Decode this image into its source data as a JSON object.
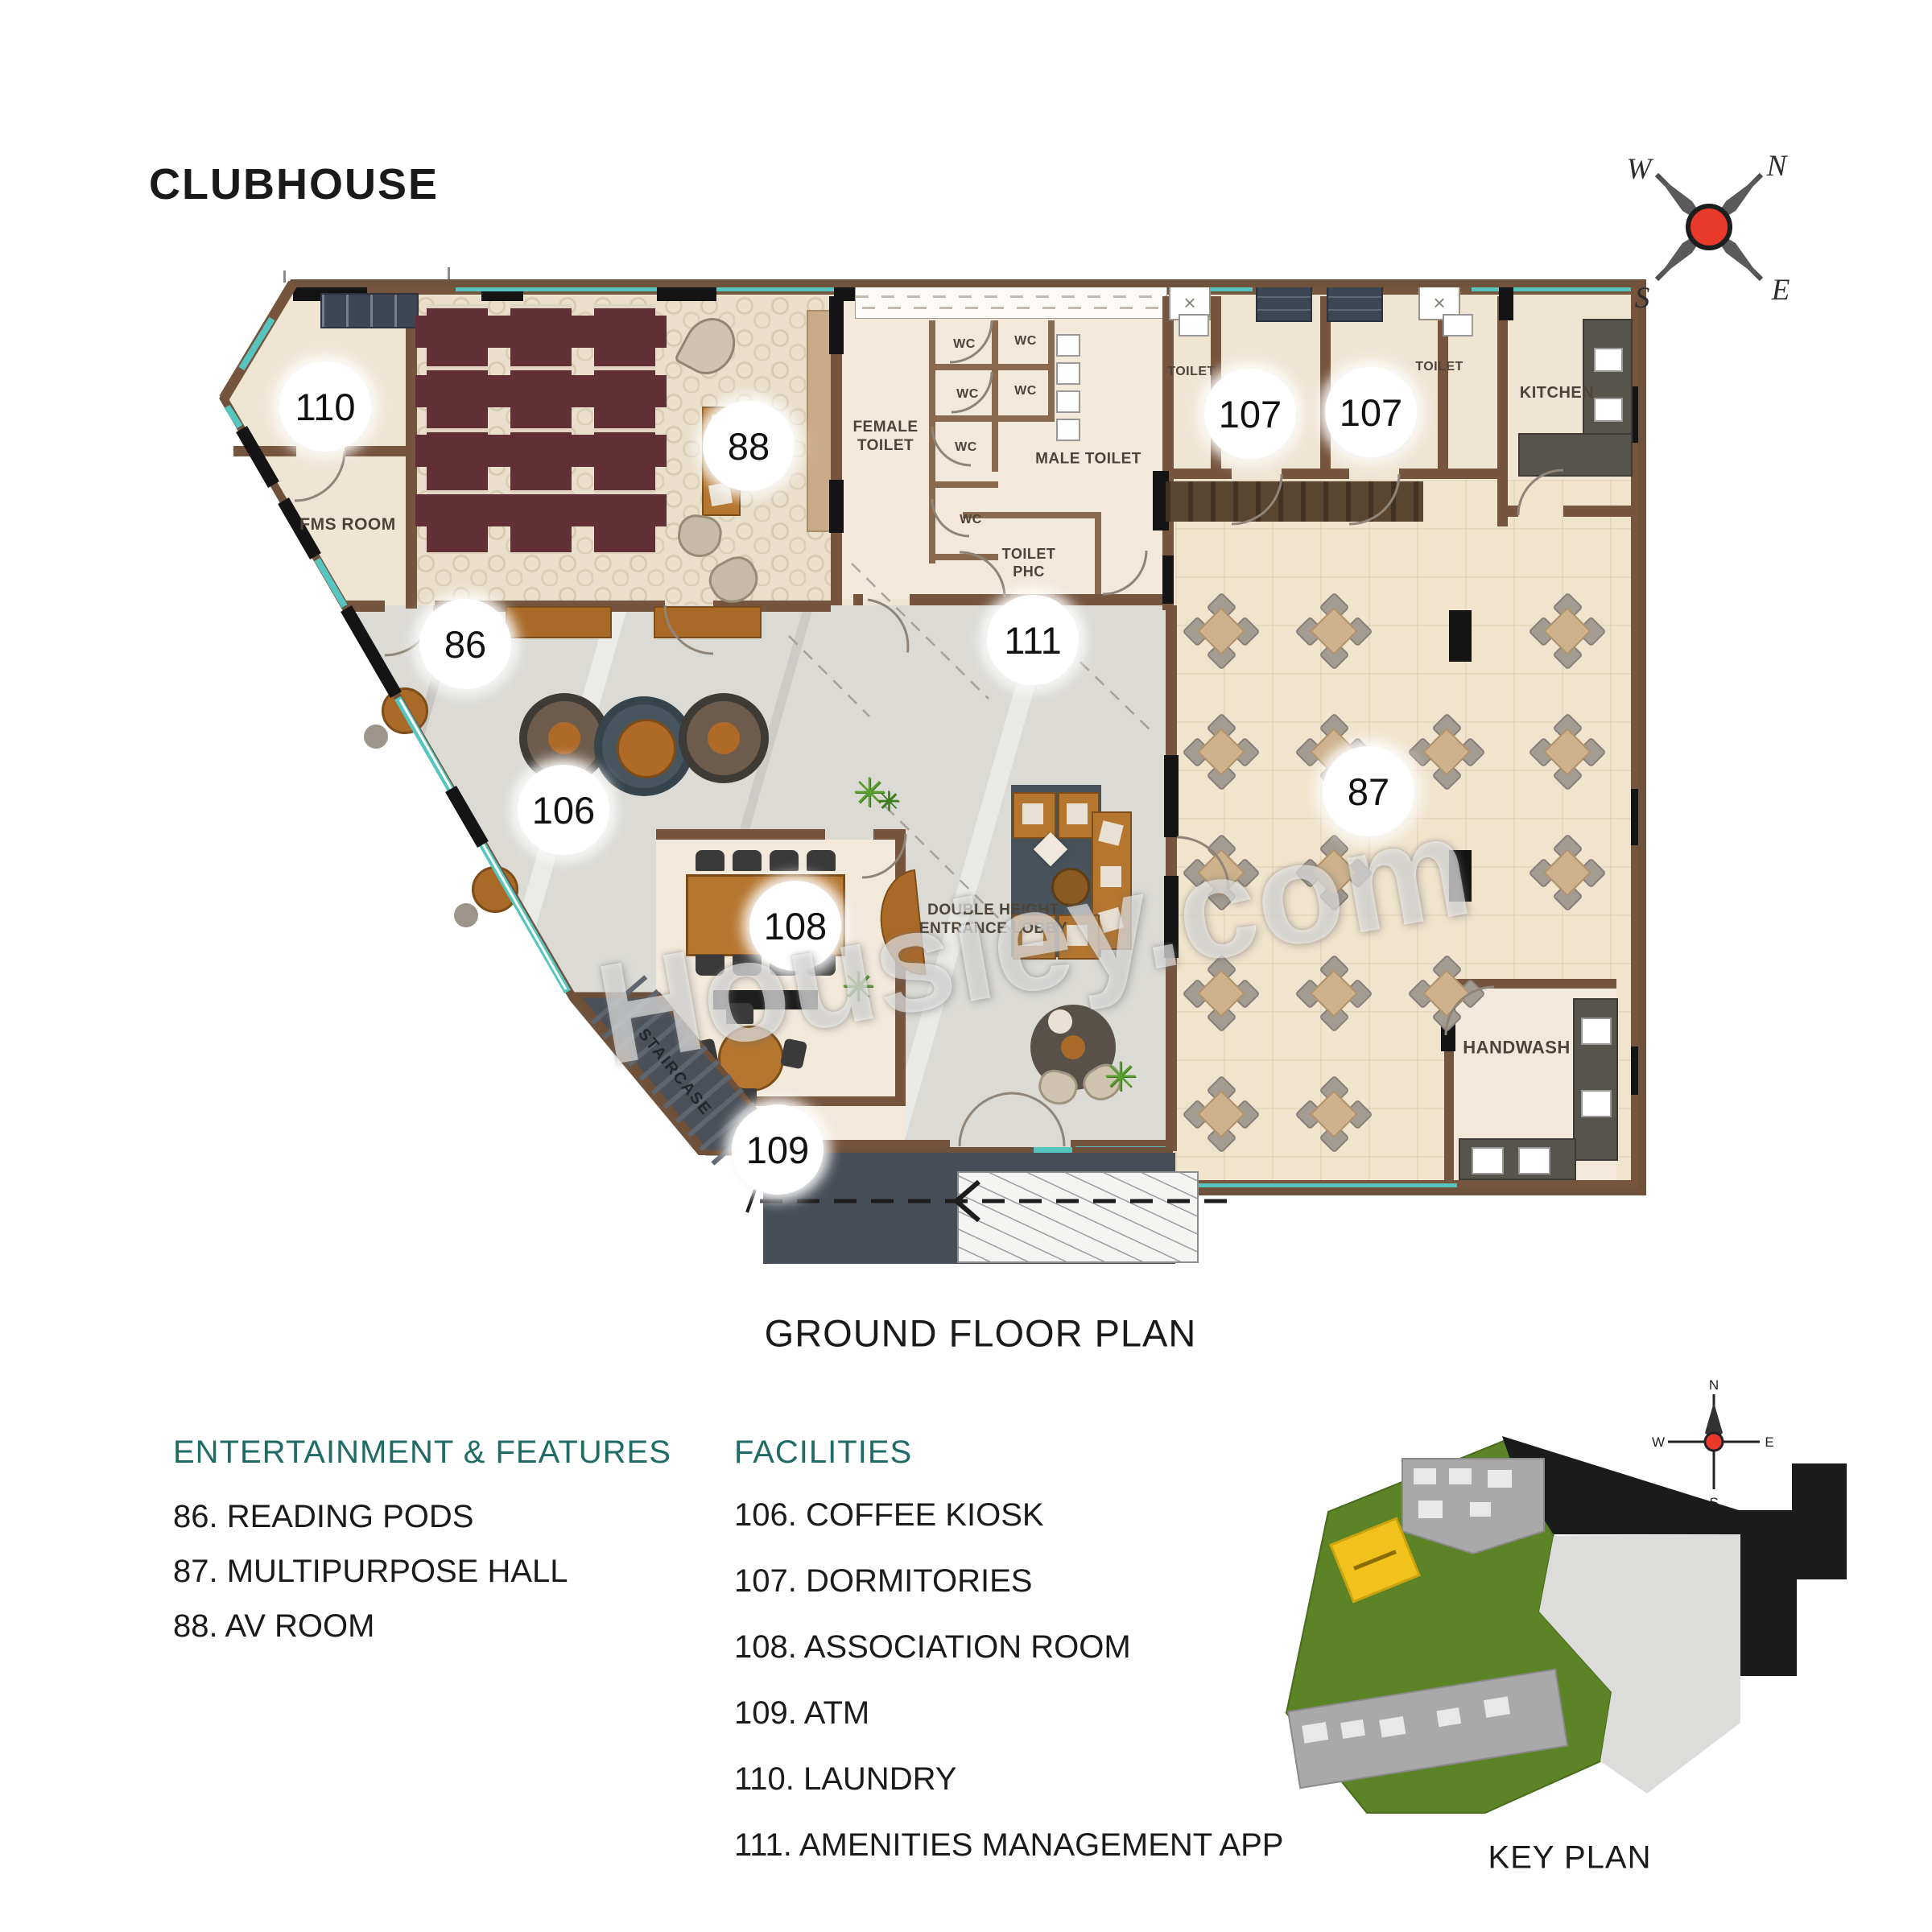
{
  "title": "CLUBHOUSE",
  "caption": "GROUND FLOOR PLAN",
  "watermark": "Housiey.com",
  "compass": {
    "n": "N",
    "e": "E",
    "s": "S",
    "w": "W"
  },
  "key_plan": {
    "label": "KEY PLAN"
  },
  "rooms": {
    "fms": "FMS ROOM",
    "female_toilet": "FEMALE TOILET",
    "male_toilet": "MALE TOILET",
    "toilet_phc": "TOILET PHC",
    "toilet": "TOILET",
    "kitchen": "KITCHEN",
    "handwash": "HANDWASH",
    "staircase": "STAIRCASE",
    "lobby": "DOUBLE HEIGHT ENTRANCE LOBBY",
    "wc": "WC"
  },
  "markers": {
    "m86": "86",
    "m87": "87",
    "m88": "88",
    "m106": "106",
    "m107": "107",
    "m108": "108",
    "m109": "109",
    "m110": "110",
    "m111": "111"
  },
  "legend": {
    "entertainment": {
      "heading": "ENTERTAINMENT & FEATURES",
      "items": [
        "86. READING PODS",
        "87. MULTIPURPOSE HALL",
        "88. AV ROOM"
      ]
    },
    "facilities": {
      "heading": "FACILITIES",
      "items": [
        "106. COFFEE KIOSK",
        "107. DORMITORIES",
        "108. ASSOCIATION ROOM",
        "109. ATM",
        "110. LAUNDRY",
        "111. AMENITIES MANAGEMENT APP"
      ]
    }
  },
  "glyphs": {
    "plant": "✳",
    "shaft_x": "×"
  },
  "colors": {
    "legend_heading": "#1f6b66",
    "glass_teal": "#57c5bf",
    "compass_red": "#e8392a",
    "keyplan_highlight": "#f2c21c",
    "wall_brown": "#76553e"
  }
}
